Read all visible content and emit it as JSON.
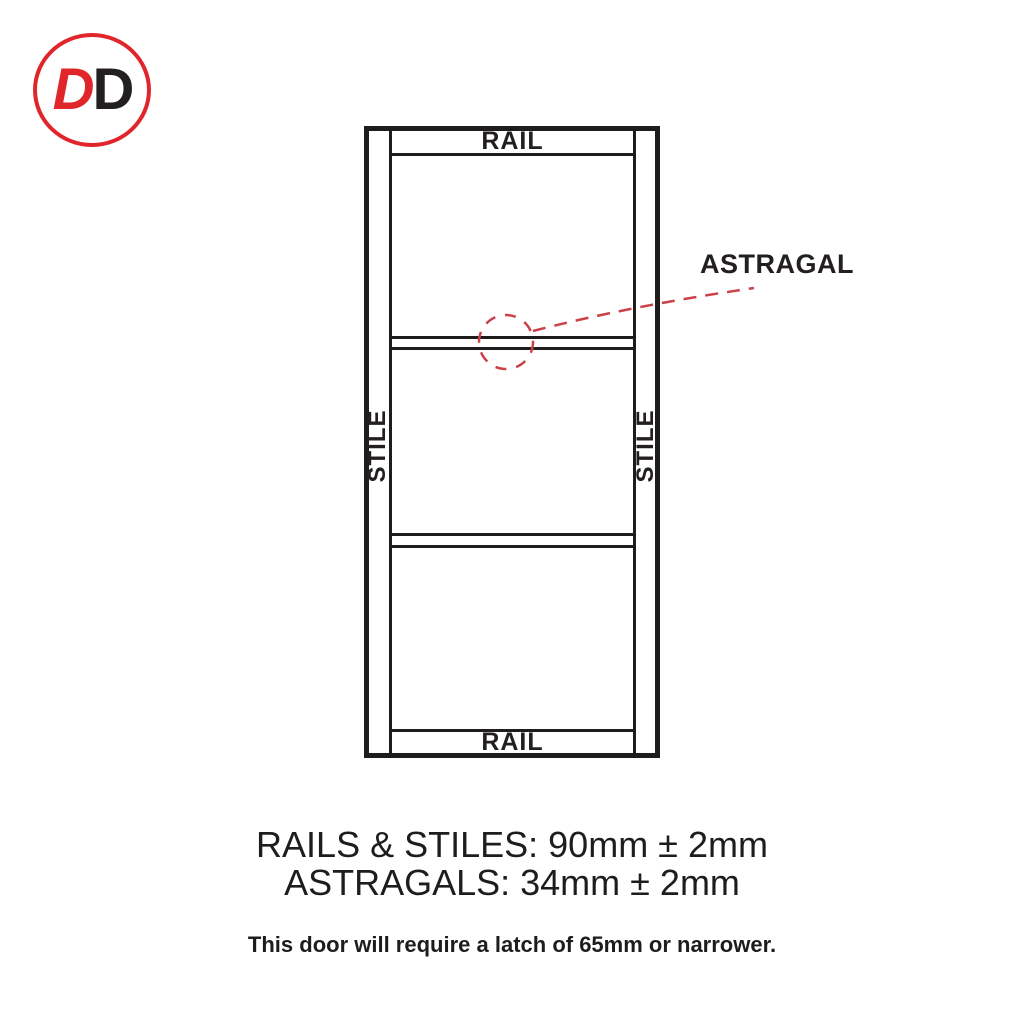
{
  "logo": {
    "letter_first": "D",
    "letter_second": "D"
  },
  "door_diagram": {
    "top_rail_label": "RAIL",
    "bottom_rail_label": "RAIL",
    "left_stile_label": "STILE",
    "right_stile_label": "STILE",
    "astragal_callout_label": "ASTRAGAL"
  },
  "specifications": {
    "rails_stiles": "RAILS & STILES: 90mm ± 2mm",
    "astragals": "ASTRAGALS: 34mm ± 2mm",
    "latch_note": "This door will require a latch of 65mm or narrower."
  },
  "colors": {
    "line_black": "#1e1d1b",
    "text_black": "#231f20",
    "logo_red": "#e0262b",
    "annotation_red": "#cb4147"
  }
}
